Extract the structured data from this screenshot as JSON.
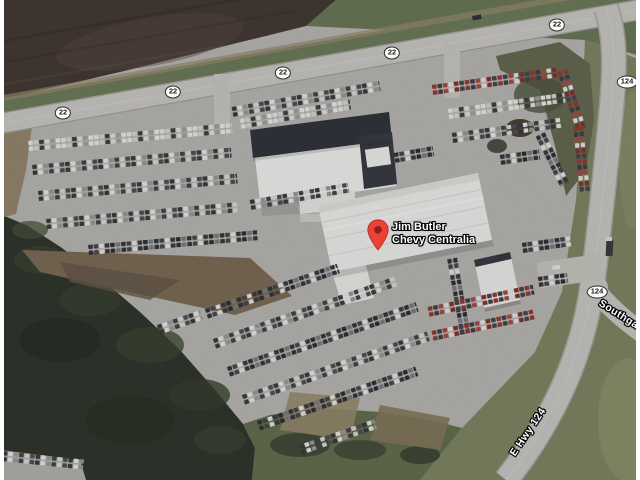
{
  "map": {
    "view_type": "satellite",
    "place_marker": {
      "name_line1": "Jim Butler",
      "name_line2": "Chevy Centralia",
      "pin_color": "#ea4335",
      "x": 378,
      "y": 250
    },
    "route_shields": [
      {
        "label": "22",
        "x": 63,
        "y": 113
      },
      {
        "label": "22",
        "x": 173,
        "y": 92
      },
      {
        "label": "22",
        "x": 283,
        "y": 73
      },
      {
        "label": "22",
        "x": 392,
        "y": 53
      },
      {
        "label": "22",
        "x": 557,
        "y": 25
      },
      {
        "label": "124",
        "x": 627,
        "y": 82
      },
      {
        "label": "124",
        "x": 597,
        "y": 292
      }
    ],
    "road_labels": [
      {
        "text": "E Hwy 124",
        "x": 528,
        "y": 432,
        "angle": -56
      },
      {
        "text": "Southgate",
        "x": 623,
        "y": 317,
        "angle": 32
      }
    ],
    "colors": {
      "shield_background": "#fcfcfa",
      "shield_border": "#2b2b2b",
      "label_text": "#ffffff"
    }
  }
}
